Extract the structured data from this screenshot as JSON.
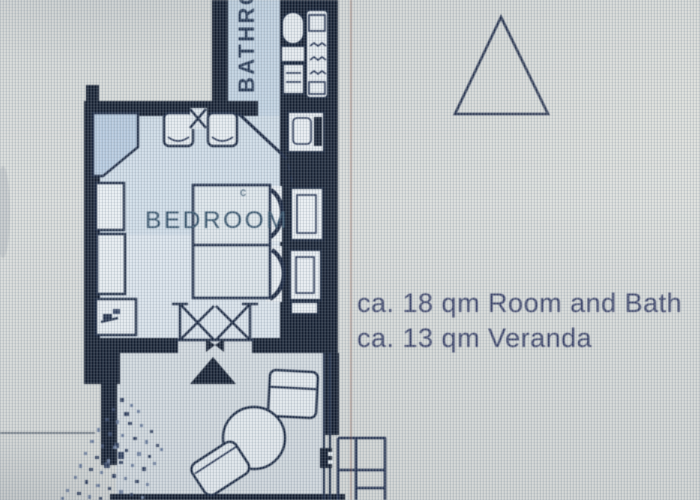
{
  "plan": {
    "texts": {
      "bathroom_label": "BATHRO",
      "bedroom_label": "BEDROOM",
      "bed_mark": "c",
      "area_note_line1": "ca. 18 qm Room and Bath",
      "area_note_line2": "ca.  13 qm Veranda"
    },
    "colors": {
      "wall": "#0d1729",
      "line": "#15233f",
      "bathroom_floor": "#c3d4e3",
      "bedroom_floor": "#cfdce7",
      "veranda_floor": "#d6dde2",
      "furniture_fill": "#e7edf1",
      "wardrobe_fill": "#b6cadf",
      "bathroom_text": "#20324e",
      "bedroom_text": "#2c4a63",
      "note_text": "#353d64",
      "background": "#d8dbd9",
      "photo_fringe": "#8a5040"
    }
  }
}
